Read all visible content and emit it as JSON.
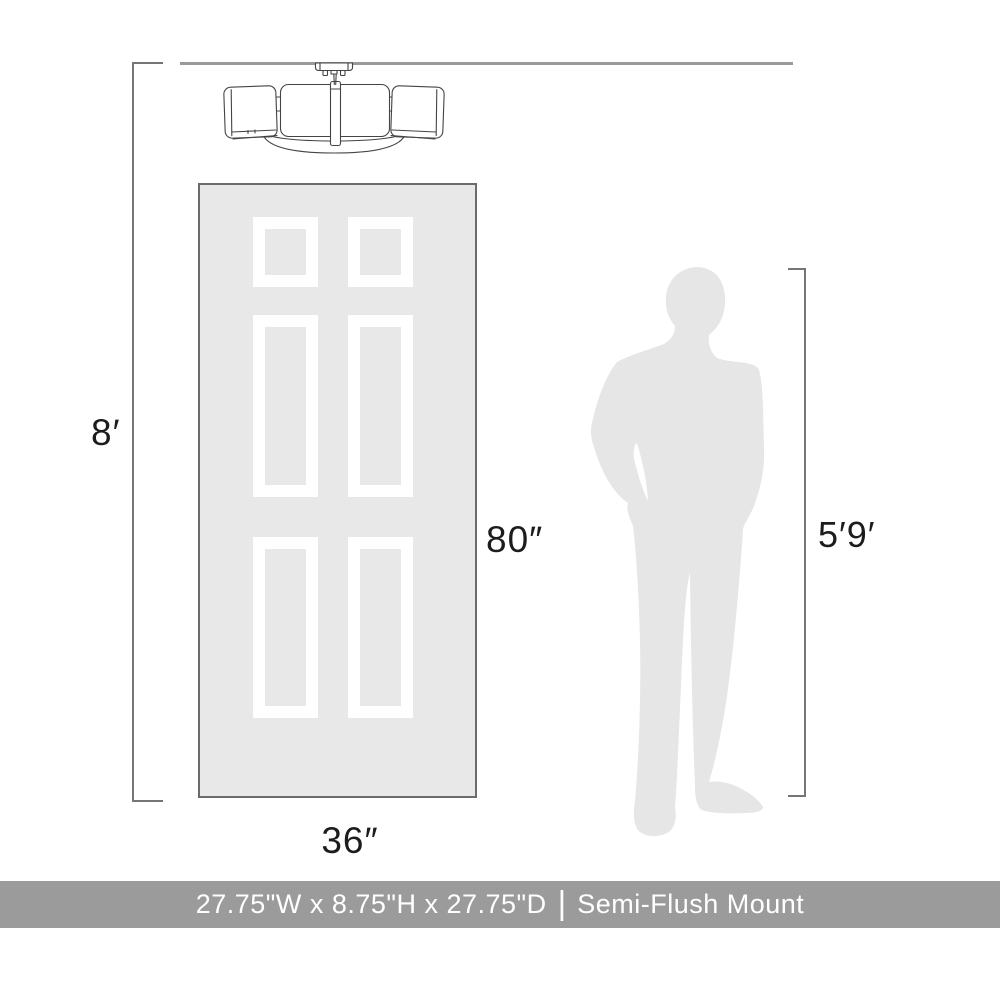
{
  "labels": {
    "ceiling_height": "8′",
    "door_height": "80″",
    "door_width": "36″",
    "person_height": "5′9′"
  },
  "banner": {
    "dimensions": "27.75\"W x 8.75\"H x 27.75\"D",
    "separator": "|",
    "mount_type": "Semi-Flush Mount"
  },
  "icons": {
    "fixture": "semi-flush-mount-light-illustration",
    "door": "six-panel-door-silhouette",
    "person": "standing-man-silhouette"
  },
  "colors": {
    "background": "#ffffff",
    "silhouette_gray": "#e8e8e8",
    "person_gray": "#e6e6e6",
    "door_border": "#6b6b6b",
    "dimension_line": "#757575",
    "ceiling_line": "#9a9a9a",
    "fixture_stroke": "#444444",
    "banner_background": "#9b9b9b",
    "banner_text": "#ffffff",
    "label_text": "#1c1c1c"
  }
}
